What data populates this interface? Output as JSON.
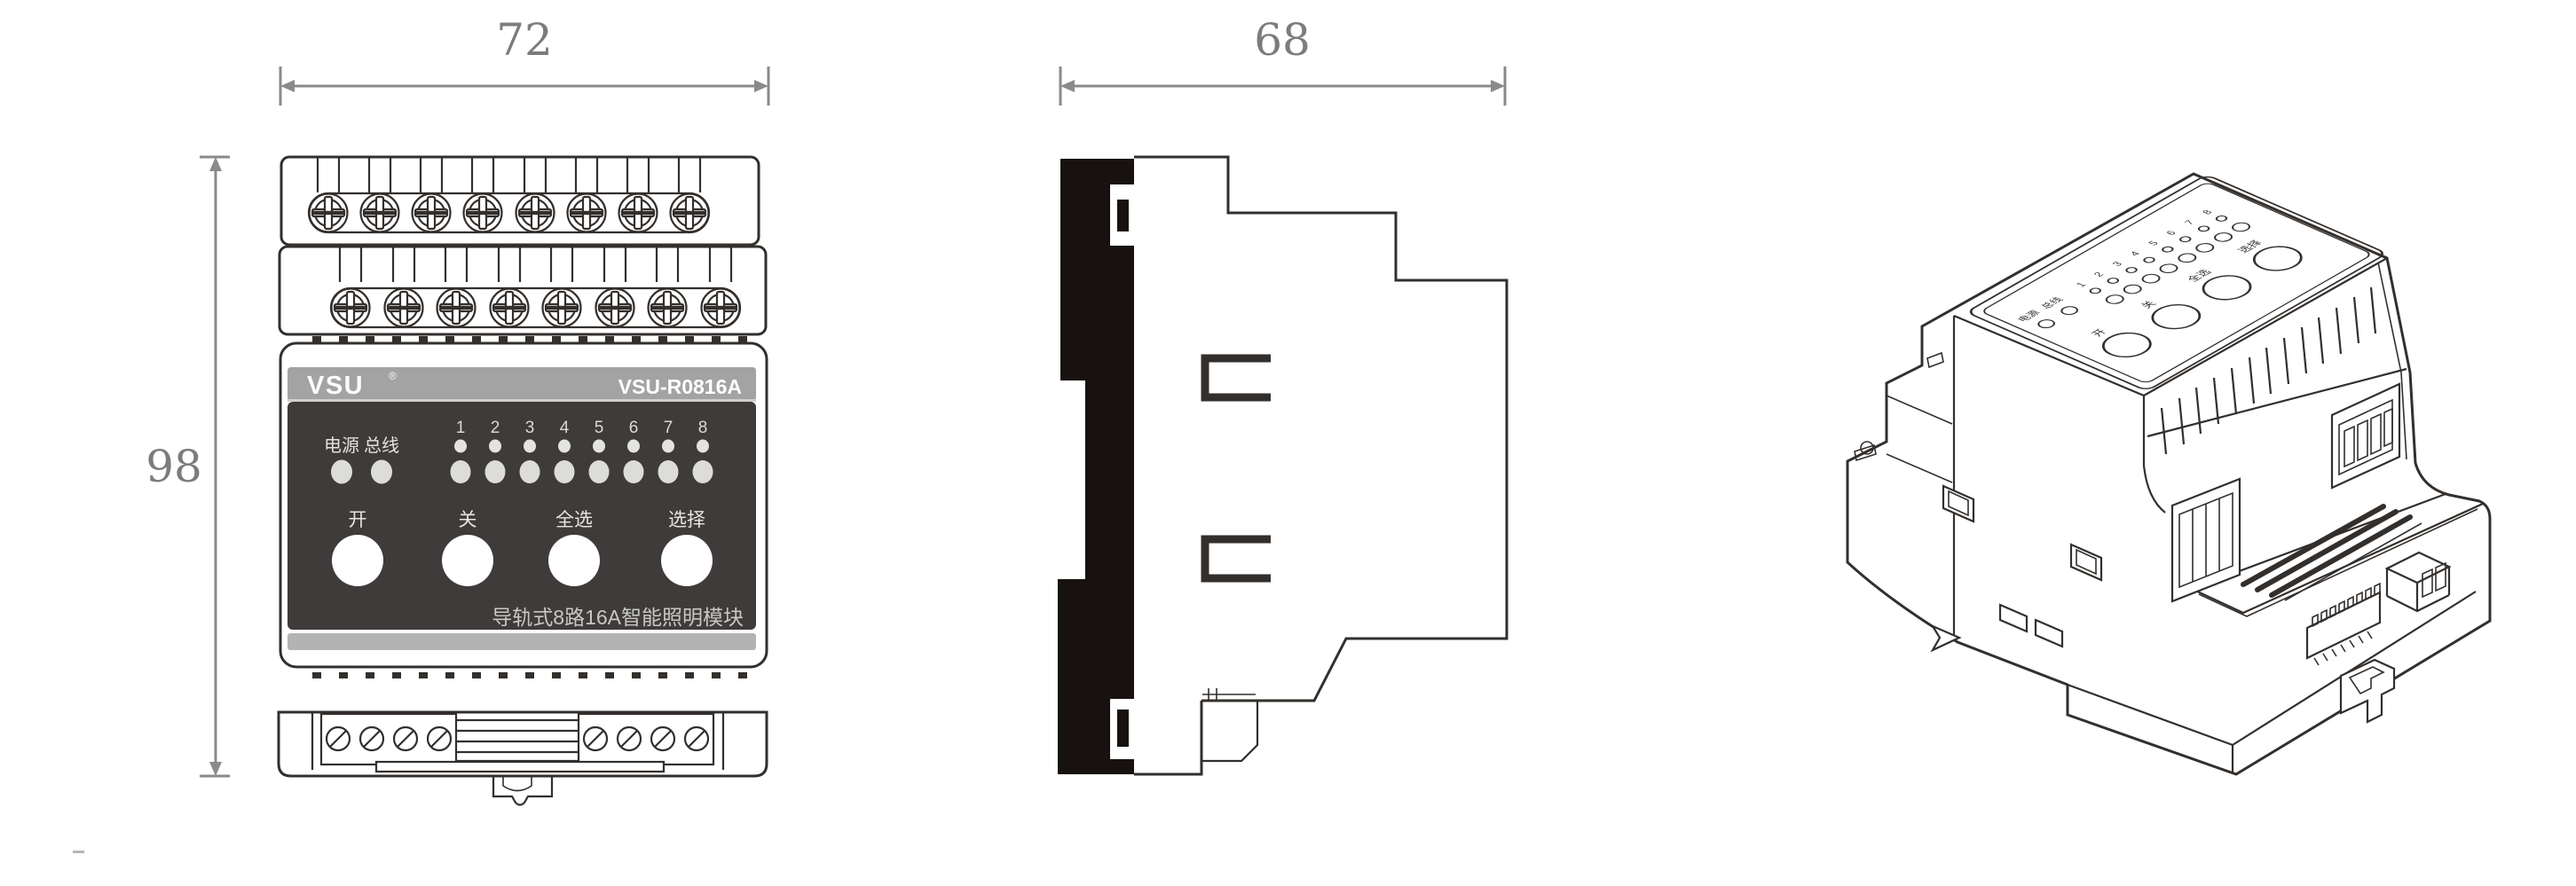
{
  "title": "VSU-R0816A rail-mounted lighting module dimension drawing",
  "dimensions": {
    "front_width_mm": "72",
    "side_depth_mm": "68",
    "front_height_mm": "98"
  },
  "front_panel": {
    "brand": "VSU",
    "reg_mark": "®",
    "model": "VSU-R0816A",
    "power_label": "电源",
    "bus_label": "总线",
    "channels": [
      "1",
      "2",
      "3",
      "4",
      "5",
      "6",
      "7",
      "8"
    ],
    "button_on": "开",
    "button_off": "关",
    "button_all": "全选",
    "button_select": "选择",
    "product_name": "导轨式8路16A智能照明模块"
  },
  "colors": {
    "line_art": "#332f2c",
    "dimension_gray": "#7c7c7c",
    "header_bar_gray": "#a3a3a3",
    "panel_dark": "#3e3b3a",
    "stripe_gray": "#b3b3b3",
    "led_fill": "#dcdcda",
    "led_small_fill": "#e3e3e1",
    "button_fill": "#ffffff",
    "din_bar_black": "#17120f"
  }
}
